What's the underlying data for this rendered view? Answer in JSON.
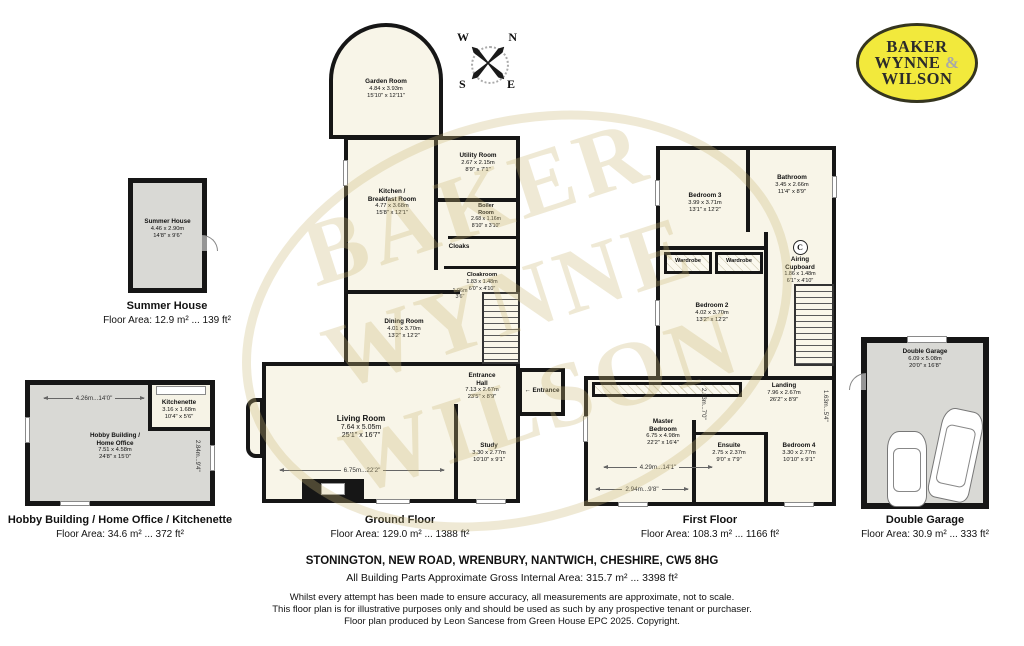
{
  "logo": {
    "line1": "BAKER",
    "line2": "WYNNE",
    "amp": "&",
    "line3": "WILSON"
  },
  "compass": {
    "nw": "W",
    "ne": "N",
    "sw": "S",
    "se": "E"
  },
  "watermark": {
    "line1": "BAKER",
    "line2": "WYNNE",
    "line3": "WILSON"
  },
  "icons": {
    "entrance_arrow": "←"
  },
  "buildings": {
    "summer_house": {
      "caption": "Summer House",
      "area": "Floor Area: 12.9 m² ... 139 ft²",
      "room": {
        "name": "Summer House",
        "m": "4.46 x 2.90m",
        "ft": "14'8\" x 9'6\""
      }
    },
    "hobby": {
      "caption": "Hobby Building / Home Office / Kitchenette",
      "area": "Floor Area: 34.6 m² ... 372 ft²",
      "rooms": {
        "main": {
          "name": "Hobby Building /",
          "name2": "Home Office",
          "m": "7.51 x 4.58m",
          "ft": "24'8\" x 15'0\""
        },
        "kitchenette": {
          "name": "Kitchenette",
          "m": "3.16 x 1.68m",
          "ft": "10'4\" x 5'6\""
        }
      },
      "dims": {
        "w": "4.26m...14'0\"",
        "h": "2.84m...9'4\""
      }
    },
    "ground": {
      "caption": "Ground Floor",
      "area": "Floor Area: 129.0 m² ... 1388 ft²",
      "rooms": {
        "garden": {
          "name": "Garden Room",
          "m": "4.84 x 3.93m",
          "ft": "15'10\" x 12'11\""
        },
        "kitchen": {
          "name": "Kitchen /",
          "name2": "Breakfast Room",
          "m": "4.77 x 3.68m",
          "ft": "15'8\" x 12'1\""
        },
        "utility": {
          "name": "Utility Room",
          "m": "2.67 x 2.15m",
          "ft": "8'9\" x 7'1\""
        },
        "boiler": {
          "name": "Boiler",
          "name2": "Room",
          "m": "2.68 x 1.16m",
          "ft": "8'10\" x 3'10\""
        },
        "cloaks": {
          "name": "Cloaks"
        },
        "cloakroom": {
          "name": "Cloakroom",
          "m": "1.83 x 1.48m",
          "ft": "6'0\" x 4'10\""
        },
        "dining": {
          "name": "Dining Room",
          "m": "4.01 x 3.70m",
          "ft": "13'2\" x 12'2\""
        },
        "hall": {
          "name": "Entrance",
          "name2": "Hall",
          "m": "7.13 x 2.67m",
          "ft": "23'5\" x 8'9\""
        },
        "living": {
          "name": "Living Room",
          "m": "7.64 x 5.05m",
          "ft": "25'1\" x 16'7\""
        },
        "study": {
          "name": "Study",
          "m": "3.30 x 2.77m",
          "ft": "10'10\" x 9'1\""
        }
      },
      "entrance_label": "Entrance",
      "dims": {
        "living_w": "6.75m...22'2\"",
        "hall_w": "1.06m",
        "hall_w_ft": "3'6\""
      }
    },
    "first": {
      "caption": "First Floor",
      "area": "Floor Area: 108.3 m² ... 1166 ft²",
      "rooms": {
        "bedroom3": {
          "name": "Bedroom 3",
          "m": "3.99 x 3.71m",
          "ft": "13'1\" x 12'2\""
        },
        "bathroom": {
          "name": "Bathroom",
          "m": "3.45 x 2.66m",
          "ft": "11'4\" x 8'9\""
        },
        "wardrobe1": {
          "name": "Wardrobe"
        },
        "wardrobe2": {
          "name": "Wardrobe"
        },
        "airing": {
          "badge": "C",
          "name": "Airing",
          "name2": "Cupboard",
          "m": "1.86 x 1.48m",
          "ft": "6'1\" x 4'10\""
        },
        "bedroom2": {
          "name": "Bedroom 2",
          "m": "4.02 x 3.70m",
          "ft": "13'2\" x 12'2\""
        },
        "landing": {
          "name": "Landing",
          "m": "7.96 x 2.67m",
          "ft": "26'2\" x 8'9\""
        },
        "master": {
          "name": "Master",
          "name2": "Bedroom",
          "m": "6.75 x 4.98m",
          "ft": "22'2\" x 16'4\""
        },
        "ensuite": {
          "name": "Ensuite",
          "m": "2.75 x 2.37m",
          "ft": "9'0\" x 7'9\""
        },
        "bedroom4": {
          "name": "Bedroom 4",
          "m": "3.30 x 2.77m",
          "ft": "10'10\" x 9'1\""
        }
      },
      "dims": {
        "master_w1": "4.29m...14'1\"",
        "master_w2": "2.94m...9'8\"",
        "ensuite_v": "2.13m...7'0\"",
        "landing_v": "1.63m...5'4\""
      }
    },
    "garage": {
      "caption": "Double Garage",
      "area": "Floor Area: 30.9 m² ... 333 ft²",
      "room": {
        "name": "Double Garage",
        "m": "6.09 x 5.08m",
        "ft": "20'0\" x 16'8\""
      }
    }
  },
  "footer": {
    "address": "STONINGTON, NEW ROAD, WRENBURY, NANTWICH, CHESHIRE, CW5 8HG",
    "gross": "All Building Parts Approximate Gross Internal Area: 315.7 m² ... 3398 ft²",
    "disclaimer1": "Whilst every attempt has been made to ensure accuracy, all measurements are approximate, not to scale.",
    "disclaimer2": "This floor plan is for illustrative purposes only and should be used as such by any prospective tenant or purchaser.",
    "disclaimer3": "Floor plan produced by Leon Sancese from Green House EPC 2025. Copyright."
  }
}
